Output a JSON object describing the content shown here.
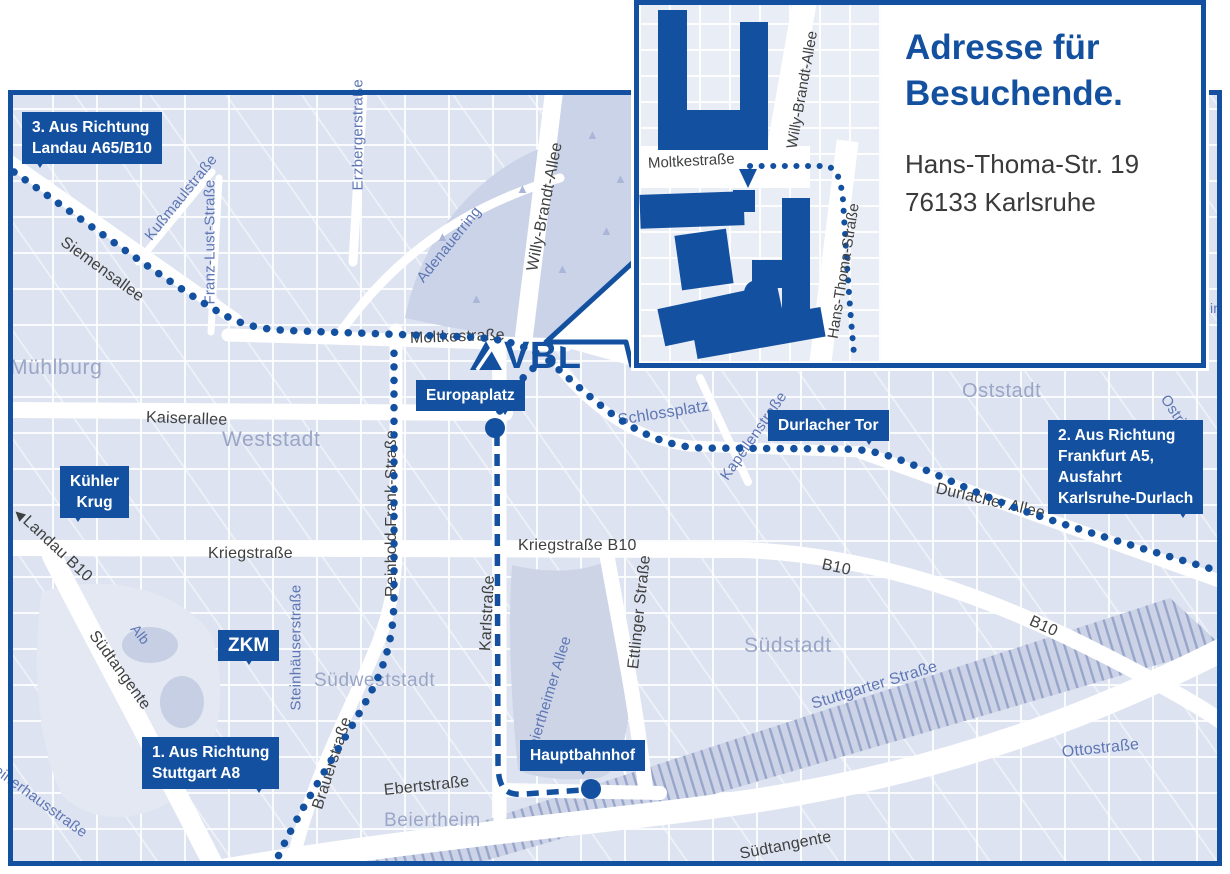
{
  "colors": {
    "accent": "#1351a0",
    "block": "#dde3f0",
    "park": "#cbd3e8",
    "area_label": "#9aa6c6",
    "blue_label": "#5e76b4",
    "dark_label": "#3f4040"
  },
  "logo": {
    "text": "VBL"
  },
  "tree_icon": "▲",
  "inset": {
    "title_line1": "Adresse für",
    "title_line2": "Besuchende.",
    "address_line1": "Hans-Thoma-Str. 19",
    "address_line2": "76133 Karlsruhe",
    "street_labels": [
      {
        "text": "Moltkestraße",
        "x": 9,
        "y": 150,
        "rot": -3,
        "size": 15
      },
      {
        "text": "Willy-Brandt-Allee",
        "x": 153,
        "y": 135,
        "rot": -80,
        "size": 15
      },
      {
        "text": "Hans-Thoma-Straße",
        "x": 194,
        "y": 325,
        "rot": -81,
        "size": 15
      }
    ],
    "buildings": [
      {
        "x": 19,
        "y": 5,
        "w": 29,
        "h": 140
      },
      {
        "x": 101,
        "y": 17,
        "w": 28,
        "h": 128
      },
      {
        "x": 48,
        "y": 105,
        "w": 55,
        "h": 40
      },
      {
        "x": 1,
        "y": 188,
        "w": 104,
        "h": 34,
        "rot": -2
      },
      {
        "x": 94,
        "y": 185,
        "w": 22,
        "h": 22
      },
      {
        "x": 39,
        "y": 227,
        "w": 52,
        "h": 55,
        "rot": -8
      },
      {
        "x": 143,
        "y": 193,
        "w": 28,
        "h": 118
      },
      {
        "x": 113,
        "y": 255,
        "w": 32,
        "h": 28
      },
      {
        "x": 21,
        "y": 291,
        "w": 122,
        "h": 38,
        "rot": -12
      },
      {
        "x": 55,
        "y": 313,
        "w": 130,
        "h": 30,
        "rot": -10
      },
      {
        "x": 105,
        "y": 275,
        "w": 26,
        "h": 26,
        "round": true
      }
    ],
    "roads": [
      {
        "x": -9,
        "y": 141,
        "w": 180,
        "h": 42,
        "rot": 0
      },
      {
        "x": 141,
        "y": -11,
        "w": 24,
        "h": 160,
        "rot": 10
      },
      {
        "x": 183,
        "y": 135,
        "w": 22,
        "h": 240,
        "rot": 7
      }
    ]
  },
  "badges": [
    {
      "id": "route-3",
      "lines": [
        "3. Aus Richtung",
        "Landau A65/B10"
      ],
      "x": 22,
      "y": 112,
      "pointer": "left"
    },
    {
      "id": "kuehler-krug",
      "lines": [
        "Kühler",
        "Krug"
      ],
      "x": 60,
      "y": 466,
      "pointer": "left",
      "center": true
    },
    {
      "id": "europaplatz",
      "lines": [
        "Europaplatz"
      ],
      "x": 416,
      "y": 380,
      "pointer": "right"
    },
    {
      "id": "durlacher-tor",
      "lines": [
        "Durlacher Tor"
      ],
      "x": 768,
      "y": 410,
      "pointer": "right"
    },
    {
      "id": "route-2",
      "lines": [
        "2. Aus Richtung",
        "Frankfurt A5,",
        "Ausfahrt",
        "Karlsruhe-Durlach"
      ],
      "x": 1048,
      "y": 420,
      "pointer": "right"
    },
    {
      "id": "zkm",
      "lines": [
        "ZKM"
      ],
      "x": 218,
      "y": 630,
      "pointer": "center",
      "size": 19
    },
    {
      "id": "route-1",
      "lines": [
        "1. Aus Richtung",
        "Stuttgart A8"
      ],
      "x": 142,
      "y": 737,
      "pointer": "right"
    },
    {
      "id": "hauptbahnhof",
      "lines": [
        "Hauptbahnhof"
      ],
      "x": 520,
      "y": 740,
      "pointer": "center"
    }
  ],
  "street_labels": [
    {
      "text": "Siemensallee",
      "x": 62,
      "y": 232,
      "rot": 36,
      "cls": "dark",
      "size": 16
    },
    {
      "text": "Kußmaulstraße",
      "x": 148,
      "y": 230,
      "rot": -51,
      "cls": "blue",
      "size": 15
    },
    {
      "text": "Franz-Lust-Straße",
      "x": 210,
      "y": 296,
      "rot": -90,
      "cls": "blue",
      "size": 15
    },
    {
      "text": "Erzbergerstraße",
      "x": 358,
      "y": 182,
      "rot": -90,
      "cls": "blue",
      "size": 15
    },
    {
      "text": "Adenauerring",
      "x": 420,
      "y": 272,
      "rot": -51,
      "cls": "blue",
      "size": 15
    },
    {
      "text": "Willy-Brandt-Allee",
      "x": 533,
      "y": 262,
      "rot": -79,
      "cls": "dark",
      "size": 16
    },
    {
      "text": "Moltkestraße",
      "x": 410,
      "y": 330,
      "rot": -2,
      "cls": "dark",
      "size": 16
    },
    {
      "text": "Kaiserallee",
      "x": 146,
      "y": 409,
      "rot": 2,
      "cls": "dark",
      "size": 16
    },
    {
      "text": "Kriegstraße",
      "x": 208,
      "y": 545,
      "rot": 0,
      "cls": "dark",
      "size": 16
    },
    {
      "text": "Kriegstraße B10",
      "x": 518,
      "y": 537,
      "rot": 0,
      "cls": "dark",
      "size": 16
    },
    {
      "text": "B10",
      "x": 822,
      "y": 556,
      "rot": 12,
      "cls": "dark",
      "size": 16
    },
    {
      "text": "B10",
      "x": 1030,
      "y": 612,
      "rot": 24,
      "cls": "dark",
      "size": 16
    },
    {
      "text": "Durlacher Allee",
      "x": 936,
      "y": 480,
      "rot": 13,
      "cls": "dark",
      "size": 16
    },
    {
      "text": "Kapellenstraße",
      "x": 724,
      "y": 470,
      "rot": -55,
      "cls": "blue",
      "size": 15
    },
    {
      "text": "Schlossplatz",
      "x": 618,
      "y": 412,
      "rot": -9,
      "cls": "blue",
      "size": 16
    },
    {
      "text": "Reinhold-Frank-Straße",
      "x": 392,
      "y": 588,
      "rot": -90,
      "cls": "dark",
      "size": 16
    },
    {
      "text": "Karlstraße",
      "x": 486,
      "y": 642,
      "rot": -87,
      "cls": "dark",
      "size": 16
    },
    {
      "text": "Ettlinger Straße",
      "x": 634,
      "y": 660,
      "rot": -84,
      "cls": "dark",
      "size": 16
    },
    {
      "text": "Beiertheimer Allee",
      "x": 530,
      "y": 748,
      "rot": -73,
      "cls": "blue",
      "size": 15
    },
    {
      "text": "Steinhäuserstraße",
      "x": 296,
      "y": 702,
      "rot": -90,
      "cls": "blue",
      "size": 15
    },
    {
      "text": "Südtangente",
      "x": 92,
      "y": 624,
      "rot": 54,
      "cls": "dark",
      "size": 16
    },
    {
      "text": "Alb",
      "x": 134,
      "y": 618,
      "rot": 52,
      "cls": "blue",
      "size": 14
    },
    {
      "text": "Landau B10",
      "x": 16,
      "y": 502,
      "rot": 43,
      "cls": "dark",
      "size": 16,
      "icon": "◀"
    },
    {
      "text": "Brauerstraße",
      "x": 318,
      "y": 800,
      "rot": -72,
      "cls": "dark",
      "size": 16
    },
    {
      "text": "Ebertstraße",
      "x": 384,
      "y": 782,
      "rot": -6,
      "cls": "dark",
      "size": 16
    },
    {
      "text": "Stuttgarter Straße",
      "x": 812,
      "y": 696,
      "rot": -17,
      "cls": "blue",
      "size": 16
    },
    {
      "text": "Ottostraße",
      "x": 1062,
      "y": 744,
      "rot": -6,
      "cls": "blue",
      "size": 16
    },
    {
      "text": "Südtangente",
      "x": 740,
      "y": 846,
      "rot": -11,
      "cls": "dark",
      "size": 16
    },
    {
      "text": "Weiherhausstraße",
      "x": -16,
      "y": 752,
      "rot": 36,
      "cls": "blue",
      "size": 15
    },
    {
      "text": "Ostring",
      "x": 1164,
      "y": 388,
      "rot": 56,
      "cls": "blue",
      "size": 15
    },
    {
      "text": "ein",
      "x": 1202,
      "y": 300,
      "rot": 0,
      "cls": "blue",
      "size": 14
    }
  ],
  "area_labels": [
    {
      "text": "Mühlburg",
      "x": 10,
      "y": 356,
      "size": 21
    },
    {
      "text": "Weststadt",
      "x": 222,
      "y": 428,
      "size": 21
    },
    {
      "text": "Oststadt",
      "x": 962,
      "y": 380,
      "size": 20
    },
    {
      "text": "Südstadt",
      "x": 744,
      "y": 634,
      "size": 21
    },
    {
      "text": "Südweststadt",
      "x": 314,
      "y": 670,
      "size": 19
    },
    {
      "text": "Beiertheim",
      "x": 384,
      "y": 810,
      "size": 19
    }
  ],
  "markers": [
    {
      "name": "europaplatz-stop",
      "x": 495,
      "y": 428
    },
    {
      "name": "hauptbahnhof-stop",
      "x": 591,
      "y": 789
    }
  ],
  "trees": [
    {
      "x": 436,
      "y": 230
    },
    {
      "x": 516,
      "y": 182
    },
    {
      "x": 600,
      "y": 224
    },
    {
      "x": 652,
      "y": 292
    },
    {
      "x": 470,
      "y": 292
    },
    {
      "x": 586,
      "y": 128
    },
    {
      "x": 614,
      "y": 172
    },
    {
      "x": 556,
      "y": 262
    }
  ]
}
